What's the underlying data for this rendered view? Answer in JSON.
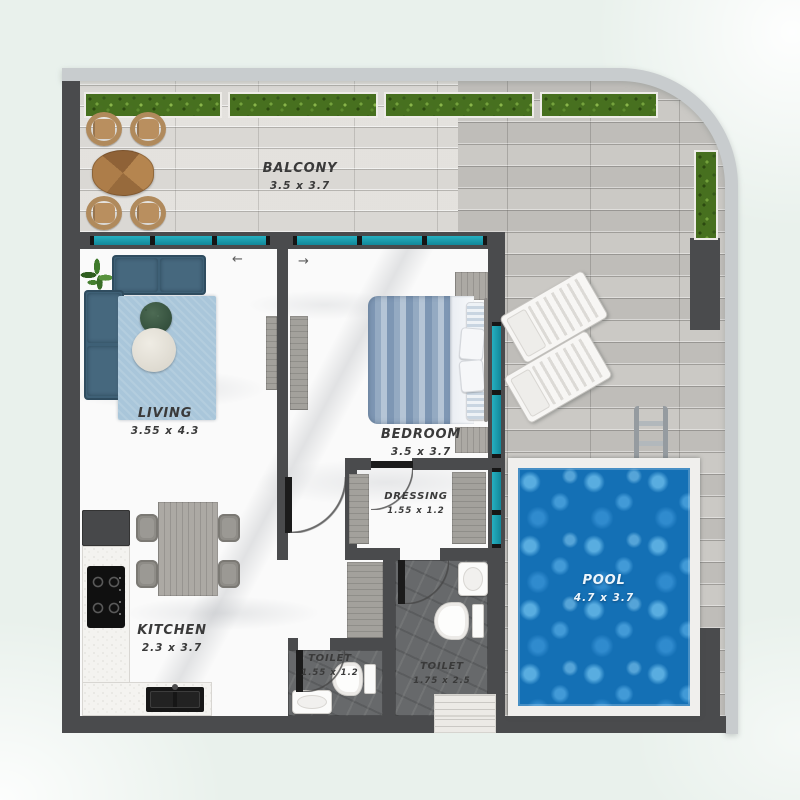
{
  "scene": {
    "type": "apartment-floor-plan-top-view"
  },
  "rooms": {
    "balcony": {
      "label": "BALCONY",
      "dims": "3.5  x 3.7"
    },
    "living": {
      "label": "LIVING",
      "dims": "3.55  x 4.3"
    },
    "bedroom": {
      "label": "BEDROOM",
      "dims": "3.5  x 3.7"
    },
    "dressing": {
      "label": "DRESSING",
      "dims": "1.55 x 1.2"
    },
    "kitchen": {
      "label": "KITCHEN",
      "dims": "2.3  x 3.7"
    },
    "toilet_small": {
      "label": "TOILET",
      "dims": "1.55 x 1.2"
    },
    "toilet_large": {
      "label": "TOILET",
      "dims": "1.75 x 2.5"
    },
    "pool": {
      "label": "POOL",
      "dims": "4.7  x 3.7"
    }
  },
  "icons": {
    "door_swing_left": "←",
    "door_swing_right": "→"
  },
  "colors": {
    "background": "#e9f1ec",
    "wall": "#4a4b4d",
    "rail": "#c8ccce",
    "window_glass": "#1a9fb2",
    "pool_water": "#1470b5",
    "sofa": "#3e6076",
    "rug": "#a9c6da",
    "hedge": "#47701f",
    "outdoor_wood": "#b5854f"
  },
  "furniture": [
    "hedge-planters",
    "outdoor-dining-set",
    "sofa",
    "rug",
    "coffee-tables",
    "plant",
    "tv-unit",
    "bed",
    "wardrobes",
    "dining-set",
    "kitchen-counter",
    "cooktop",
    "kitchen-sink",
    "fridge",
    "toilets",
    "washbasins",
    "sun-loungers",
    "pool-ladder"
  ]
}
